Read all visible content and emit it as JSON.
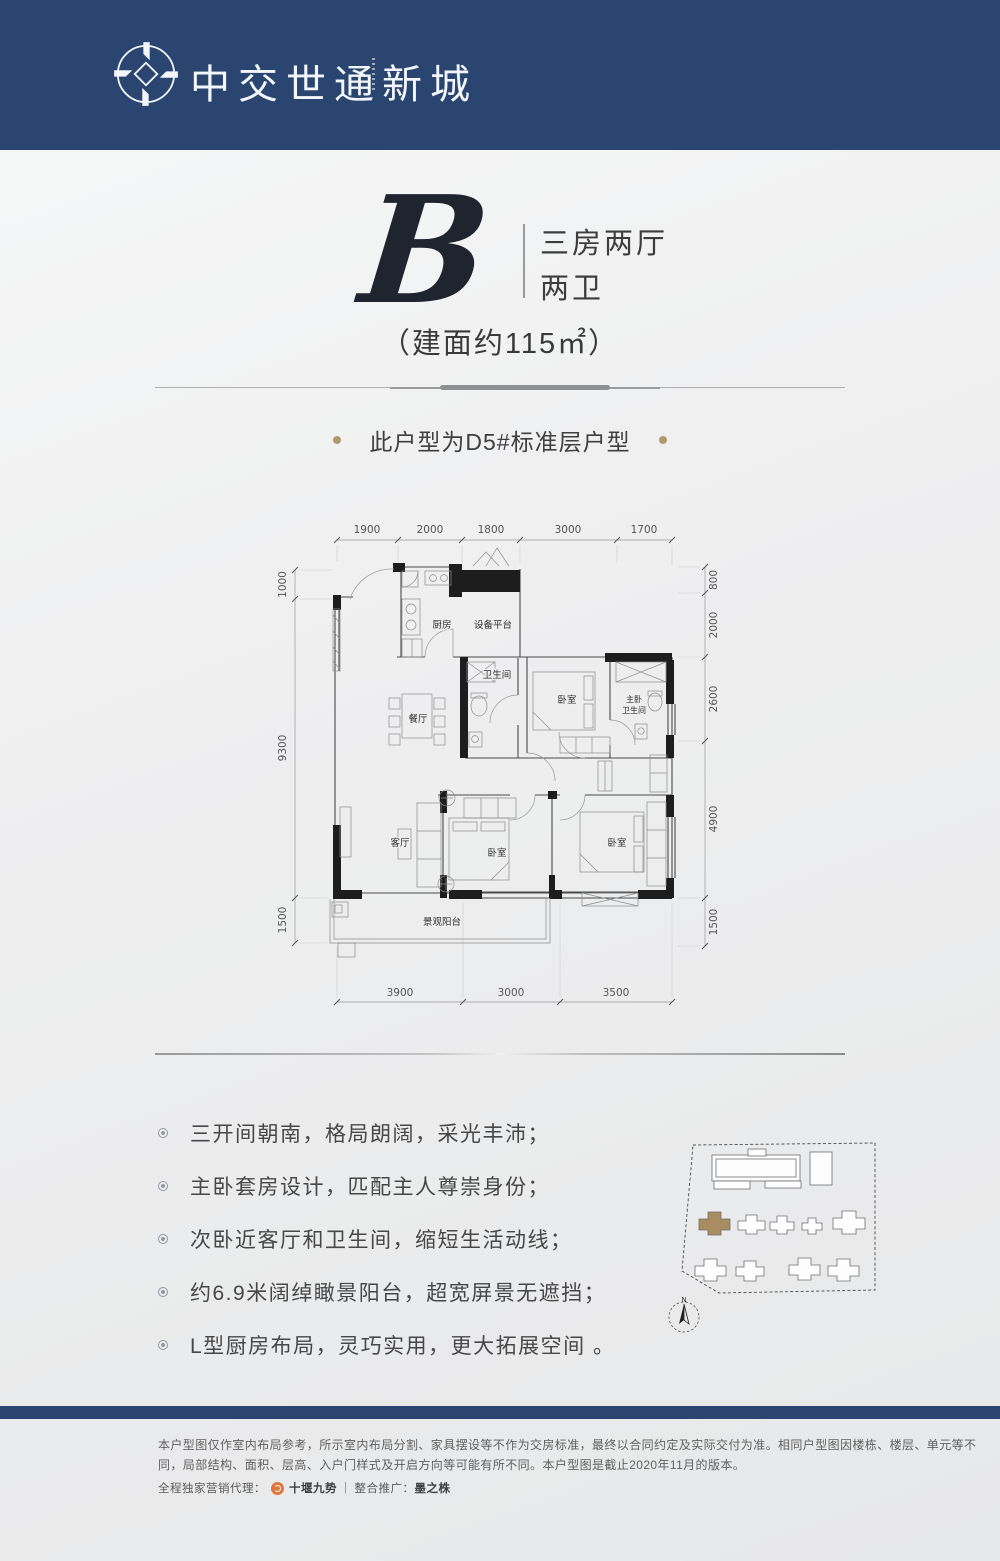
{
  "header": {
    "brand": "中交世通新城",
    "bg_color": "#2a4670"
  },
  "hero": {
    "letter": "B",
    "rooms_line1": "三房两厅",
    "rooms_line2": "两卫",
    "area": "（建面约115㎡）",
    "note": "此户型为D5#标准层户型",
    "note_dot_color": "#b09a6b"
  },
  "floorplan": {
    "dims_top": [
      "1900",
      "2000",
      "1800",
      "3000",
      "1700"
    ],
    "dims_left": [
      "1000",
      "9300",
      "1500"
    ],
    "dims_right": [
      "800",
      "2000",
      "2600",
      "4900",
      "1500"
    ],
    "dims_bottom": [
      "3900",
      "3000",
      "3500"
    ],
    "rooms": {
      "kitchen": "厨房",
      "equipment": "设备平台",
      "bath": "卫生间",
      "bedroom_top": "卧室",
      "master_bath_line1": "主卧",
      "master_bath_line2": "卫生间",
      "dining": "餐厅",
      "living": "客厅",
      "bedroom_mid": "卧室",
      "bedroom_right": "卧室",
      "balcony": "景观阳台"
    }
  },
  "features": [
    "三开间朝南，格局朗阔，采光丰沛；",
    "主卧套房设计，匹配主人尊崇身份；",
    "次卧近客厅和卫生间，缩短生活动线；",
    "约6.9米阔绰瞰景阳台，超宽屏景无遮挡；",
    "L型厨房布局，灵巧实用，更大拓展空间 。"
  ],
  "siteplan": {
    "north_label": "N",
    "highlight_color": "#a98c60"
  },
  "footer": {
    "disclaimer": "本户型图仅作室内布局参考，所示室内布局分割、家具摆设等不作为交房标准，最终以合同约定及实际交付为准。相同户型图因楼栋、楼层、单元等不同，局部结构、面积、层高、入户门样式及开启方向等可能有所不同。本户型图是截止2020年11月的版本。",
    "agency_label": "全程独家营销代理：",
    "agency_name": "十堰九势",
    "sep": "|",
    "promo_label": "整合推广：",
    "promo_name": "墨之株"
  }
}
